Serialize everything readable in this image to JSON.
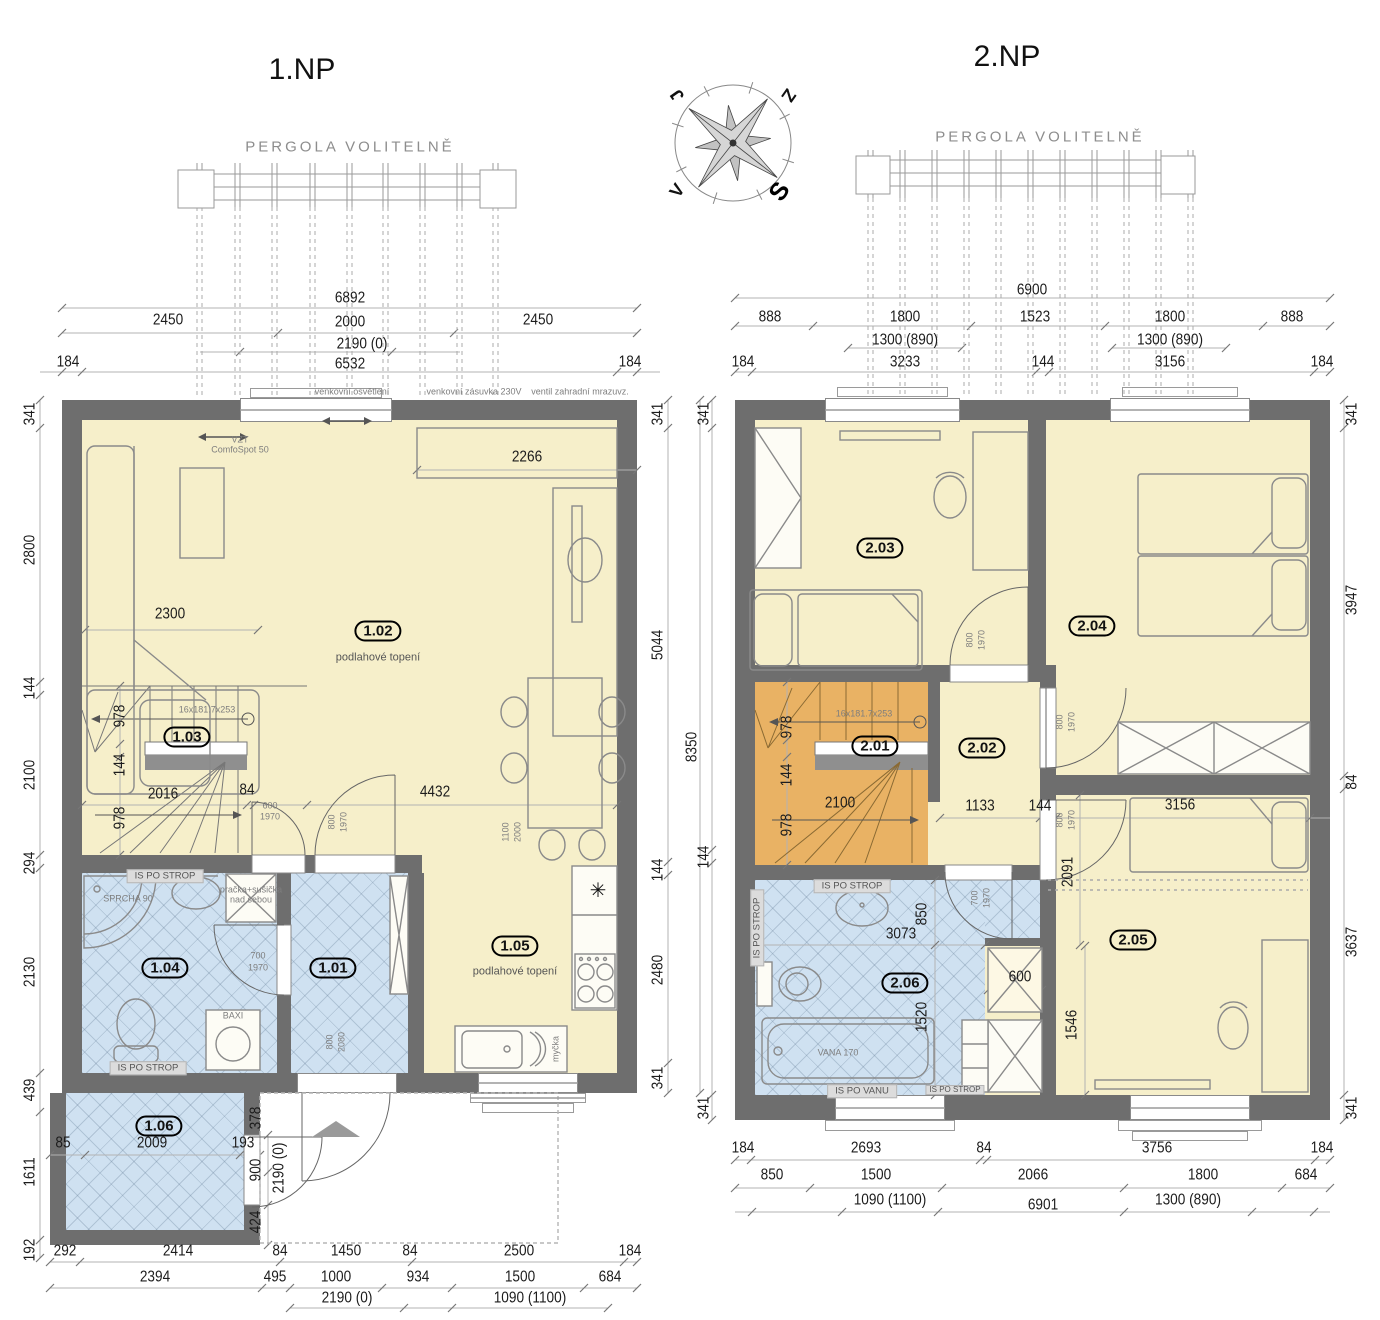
{
  "colors": {
    "wall": "#6e6e6e",
    "dry_room": "#f6efca",
    "wet_room": "#cfe1f1",
    "stairs_upper": "#e9b264",
    "band": "#dcdcdc"
  },
  "compass": {
    "ne": "Z",
    "nw": "J",
    "sw": "V",
    "se": "S"
  },
  "plan1": {
    "title": "1.NP",
    "pergola_label": "PERGOLA VOLITELNĚ",
    "labels": [
      {
        "t": "6892",
        "x": 350,
        "y": 298,
        "s": "dim"
      },
      {
        "t": "2450",
        "x": 168,
        "y": 320,
        "s": "dim"
      },
      {
        "t": "2000",
        "x": 350,
        "y": 322,
        "s": "dim"
      },
      {
        "t": "2450",
        "x": 538,
        "y": 320,
        "s": "dim"
      },
      {
        "t": "2190 (0)",
        "x": 362,
        "y": 344,
        "s": "dim"
      },
      {
        "t": "184",
        "x": 68,
        "y": 362,
        "s": "dim"
      },
      {
        "t": "6532",
        "x": 350,
        "y": 364,
        "s": "dim"
      },
      {
        "t": "184",
        "x": 630,
        "y": 362,
        "s": "dim"
      },
      {
        "t": "venkovní osvětlení",
        "x": 352,
        "y": 392,
        "s": "tiny"
      },
      {
        "t": "venkovní zásuvka 230V",
        "x": 474,
        "y": 392,
        "s": "tiny"
      },
      {
        "t": "ventil zahradní mrazuvz.",
        "x": 580,
        "y": 392,
        "s": "tiny"
      },
      {
        "t": "VZT",
        "x": 240,
        "y": 440,
        "s": "tiny"
      },
      {
        "t": "ComfoSpot 50",
        "x": 240,
        "y": 450,
        "s": "tiny"
      },
      {
        "t": "341",
        "x": 30,
        "y": 414,
        "s": "dimr"
      },
      {
        "t": "2800",
        "x": 30,
        "y": 550,
        "s": "dimr"
      },
      {
        "t": "144",
        "x": 30,
        "y": 688,
        "s": "dimr"
      },
      {
        "t": "2100",
        "x": 30,
        "y": 775,
        "s": "dimr"
      },
      {
        "t": "294",
        "x": 30,
        "y": 863,
        "s": "dimr"
      },
      {
        "t": "2130",
        "x": 30,
        "y": 972,
        "s": "dimr"
      },
      {
        "t": "439",
        "x": 30,
        "y": 1090,
        "s": "dimr"
      },
      {
        "t": "1611",
        "x": 30,
        "y": 1172,
        "s": "dimr"
      },
      {
        "t": "192",
        "x": 30,
        "y": 1250,
        "s": "dimr"
      },
      {
        "t": "341",
        "x": 658,
        "y": 414,
        "s": "dimr"
      },
      {
        "t": "5044",
        "x": 658,
        "y": 645,
        "s": "dimr"
      },
      {
        "t": "144",
        "x": 658,
        "y": 870,
        "s": "dimr"
      },
      {
        "t": "2480",
        "x": 658,
        "y": 970,
        "s": "dimr"
      },
      {
        "t": "341",
        "x": 658,
        "y": 1078,
        "s": "dimr"
      },
      {
        "t": "8350",
        "x": 692,
        "y": 747,
        "s": "dimr"
      },
      {
        "t": "292",
        "x": 65,
        "y": 1251,
        "s": "dim"
      },
      {
        "t": "2414",
        "x": 178,
        "y": 1251,
        "s": "dim"
      },
      {
        "t": "84",
        "x": 280,
        "y": 1251,
        "s": "dim"
      },
      {
        "t": "1450",
        "x": 346,
        "y": 1251,
        "s": "dim"
      },
      {
        "t": "84",
        "x": 410,
        "y": 1251,
        "s": "dim"
      },
      {
        "t": "2500",
        "x": 519,
        "y": 1251,
        "s": "dim"
      },
      {
        "t": "184",
        "x": 630,
        "y": 1251,
        "s": "dim"
      },
      {
        "t": "2394",
        "x": 155,
        "y": 1277,
        "s": "dim"
      },
      {
        "t": "495",
        "x": 275,
        "y": 1277,
        "s": "dim"
      },
      {
        "t": "1000",
        "x": 336,
        "y": 1277,
        "s": "dim"
      },
      {
        "t": "934",
        "x": 418,
        "y": 1277,
        "s": "dim"
      },
      {
        "t": "1500",
        "x": 520,
        "y": 1277,
        "s": "dim"
      },
      {
        "t": "684",
        "x": 610,
        "y": 1277,
        "s": "dim"
      },
      {
        "t": "2190 (0)",
        "x": 347,
        "y": 1298,
        "s": "dim"
      },
      {
        "t": "1090 (1100)",
        "x": 530,
        "y": 1298,
        "s": "dim"
      },
      {
        "t": "1.02",
        "x": 378,
        "y": 631,
        "s": "oval"
      },
      {
        "t": "podlahové topení",
        "x": 378,
        "y": 658,
        "s": "note"
      },
      {
        "t": "2266",
        "x": 527,
        "y": 457,
        "s": "dim"
      },
      {
        "t": "2300",
        "x": 170,
        "y": 614,
        "s": "dim"
      },
      {
        "t": "4432",
        "x": 435,
        "y": 792,
        "s": "dim"
      },
      {
        "t": "1.03",
        "x": 187,
        "y": 737,
        "s": "oval"
      },
      {
        "t": "16x181.7x253",
        "x": 207,
        "y": 710,
        "s": "tiny"
      },
      {
        "t": "978",
        "x": 120,
        "y": 716,
        "s": "dimr"
      },
      {
        "t": "144",
        "x": 120,
        "y": 765,
        "s": "dimr"
      },
      {
        "t": "978",
        "x": 120,
        "y": 818,
        "s": "dimr"
      },
      {
        "t": "2016",
        "x": 163,
        "y": 794,
        "s": "dim"
      },
      {
        "t": "84",
        "x": 247,
        "y": 790,
        "s": "dim"
      },
      {
        "t": "600",
        "x": 270,
        "y": 806,
        "s": "tiny"
      },
      {
        "t": "1970",
        "x": 270,
        "y": 817,
        "s": "tiny"
      },
      {
        "t": "800",
        "x": 332,
        "y": 822,
        "s": "tinyr"
      },
      {
        "t": "1970",
        "x": 344,
        "y": 822,
        "s": "tinyr"
      },
      {
        "t": "1100",
        "x": 506,
        "y": 832,
        "s": "tinyr"
      },
      {
        "t": "2000",
        "x": 518,
        "y": 832,
        "s": "tinyr"
      },
      {
        "t": "IS PO STROP",
        "x": 165,
        "y": 876,
        "s": "band"
      },
      {
        "t": "IS PO STROP",
        "x": 148,
        "y": 1068,
        "s": "band"
      },
      {
        "t": "SPRCHA 90",
        "x": 128,
        "y": 899,
        "s": "tiny"
      },
      {
        "t": "pračka+sušička",
        "x": 251,
        "y": 890,
        "s": "tiny"
      },
      {
        "t": "nad sebou",
        "x": 251,
        "y": 900,
        "s": "tiny"
      },
      {
        "t": "1.04",
        "x": 165,
        "y": 968,
        "s": "oval"
      },
      {
        "t": "700",
        "x": 258,
        "y": 956,
        "s": "tiny"
      },
      {
        "t": "1970",
        "x": 258,
        "y": 968,
        "s": "tiny"
      },
      {
        "t": "1.01",
        "x": 333,
        "y": 968,
        "s": "oval"
      },
      {
        "t": "800",
        "x": 330,
        "y": 1042,
        "s": "tinyr"
      },
      {
        "t": "2080",
        "x": 342,
        "y": 1042,
        "s": "tinyr"
      },
      {
        "t": "BAXI",
        "x": 233,
        "y": 1016,
        "s": "tiny"
      },
      {
        "t": "1.05",
        "x": 515,
        "y": 946,
        "s": "oval"
      },
      {
        "t": "podlahové topení",
        "x": 515,
        "y": 972,
        "s": "note"
      },
      {
        "t": "✳",
        "x": 598,
        "y": 891,
        "s": "sym",
        "n": "fridge-freezer-icon"
      },
      {
        "t": "myčka",
        "x": 556,
        "y": 1049,
        "s": "tinyr"
      },
      {
        "t": "1.06",
        "x": 159,
        "y": 1126,
        "s": "oval"
      },
      {
        "t": "2009",
        "x": 152,
        "y": 1143,
        "s": "dim"
      },
      {
        "t": "85",
        "x": 63,
        "y": 1143,
        "s": "dim"
      },
      {
        "t": "193",
        "x": 243,
        "y": 1143,
        "s": "dim"
      },
      {
        "t": "378",
        "x": 256,
        "y": 1118,
        "s": "dimr"
      },
      {
        "t": "900",
        "x": 256,
        "y": 1170,
        "s": "dimr"
      },
      {
        "t": "2190 (0)",
        "x": 279,
        "y": 1168,
        "s": "dimr"
      },
      {
        "t": "424",
        "x": 256,
        "y": 1222,
        "s": "dimr"
      }
    ]
  },
  "plan2": {
    "title": "2.NP",
    "pergola_label": "PERGOLA VOLITELNĚ",
    "labels": [
      {
        "t": "6900",
        "x": 1032,
        "y": 290,
        "s": "dim"
      },
      {
        "t": "888",
        "x": 770,
        "y": 317,
        "s": "dim"
      },
      {
        "t": "1800",
        "x": 905,
        "y": 317,
        "s": "dim"
      },
      {
        "t": "1523",
        "x": 1035,
        "y": 317,
        "s": "dim"
      },
      {
        "t": "1800",
        "x": 1170,
        "y": 317,
        "s": "dim"
      },
      {
        "t": "888",
        "x": 1292,
        "y": 317,
        "s": "dim"
      },
      {
        "t": "1300 (890)",
        "x": 905,
        "y": 340,
        "s": "dim"
      },
      {
        "t": "1300 (890)",
        "x": 1170,
        "y": 340,
        "s": "dim"
      },
      {
        "t": "184",
        "x": 743,
        "y": 362,
        "s": "dim"
      },
      {
        "t": "3233",
        "x": 905,
        "y": 362,
        "s": "dim"
      },
      {
        "t": "144",
        "x": 1043,
        "y": 362,
        "s": "dim"
      },
      {
        "t": "3156",
        "x": 1170,
        "y": 362,
        "s": "dim"
      },
      {
        "t": "184",
        "x": 1322,
        "y": 362,
        "s": "dim"
      },
      {
        "t": "341",
        "x": 704,
        "y": 414,
        "s": "dimr"
      },
      {
        "t": "144",
        "x": 704,
        "y": 857,
        "s": "dimr"
      },
      {
        "t": "341",
        "x": 704,
        "y": 1108,
        "s": "dimr"
      },
      {
        "t": "341",
        "x": 1352,
        "y": 414,
        "s": "dimr"
      },
      {
        "t": "3947",
        "x": 1352,
        "y": 600,
        "s": "dimr"
      },
      {
        "t": "84",
        "x": 1352,
        "y": 782,
        "s": "dimr"
      },
      {
        "t": "3637",
        "x": 1352,
        "y": 942,
        "s": "dimr"
      },
      {
        "t": "341",
        "x": 1352,
        "y": 1108,
        "s": "dimr"
      },
      {
        "t": "184",
        "x": 743,
        "y": 1148,
        "s": "dim"
      },
      {
        "t": "2693",
        "x": 866,
        "y": 1148,
        "s": "dim"
      },
      {
        "t": "84",
        "x": 984,
        "y": 1148,
        "s": "dim"
      },
      {
        "t": "3756",
        "x": 1157,
        "y": 1148,
        "s": "dim"
      },
      {
        "t": "184",
        "x": 1322,
        "y": 1148,
        "s": "dim"
      },
      {
        "t": "850",
        "x": 772,
        "y": 1175,
        "s": "dim"
      },
      {
        "t": "1500",
        "x": 876,
        "y": 1175,
        "s": "dim"
      },
      {
        "t": "2066",
        "x": 1033,
        "y": 1175,
        "s": "dim"
      },
      {
        "t": "1800",
        "x": 1203,
        "y": 1175,
        "s": "dim"
      },
      {
        "t": "684",
        "x": 1306,
        "y": 1175,
        "s": "dim"
      },
      {
        "t": "1090 (1100)",
        "x": 890,
        "y": 1200,
        "s": "dim"
      },
      {
        "t": "6901",
        "x": 1043,
        "y": 1205,
        "s": "dim"
      },
      {
        "t": "1300 (890)",
        "x": 1188,
        "y": 1200,
        "s": "dim"
      },
      {
        "t": "2.03",
        "x": 880,
        "y": 548,
        "s": "oval"
      },
      {
        "t": "800",
        "x": 970,
        "y": 640,
        "s": "tinyr"
      },
      {
        "t": "1970",
        "x": 982,
        "y": 640,
        "s": "tinyr"
      },
      {
        "t": "2.04",
        "x": 1092,
        "y": 626,
        "s": "oval"
      },
      {
        "t": "16x181.7x253",
        "x": 864,
        "y": 714,
        "s": "tiny"
      },
      {
        "t": "2.01",
        "x": 875,
        "y": 746,
        "s": "oval"
      },
      {
        "t": "978",
        "x": 787,
        "y": 727,
        "s": "dimr"
      },
      {
        "t": "144",
        "x": 787,
        "y": 775,
        "s": "dimr"
      },
      {
        "t": "978",
        "x": 787,
        "y": 825,
        "s": "dimr"
      },
      {
        "t": "2100",
        "x": 840,
        "y": 803,
        "s": "dim"
      },
      {
        "t": "2.02",
        "x": 982,
        "y": 748,
        "s": "oval"
      },
      {
        "t": "1133",
        "x": 980,
        "y": 806,
        "s": "dim"
      },
      {
        "t": "144",
        "x": 1040,
        "y": 806,
        "s": "dim"
      },
      {
        "t": "800",
        "x": 1060,
        "y": 722,
        "s": "tinyr"
      },
      {
        "t": "1970",
        "x": 1072,
        "y": 722,
        "s": "tinyr"
      },
      {
        "t": "800",
        "x": 1060,
        "y": 820,
        "s": "tinyr"
      },
      {
        "t": "1970",
        "x": 1072,
        "y": 820,
        "s": "tinyr"
      },
      {
        "t": "IS PO STROP",
        "x": 852,
        "y": 886,
        "s": "band"
      },
      {
        "t": "IS PO STROP",
        "x": 757,
        "y": 928,
        "s": "bandr"
      },
      {
        "t": "3073",
        "x": 901,
        "y": 934,
        "s": "dim"
      },
      {
        "t": "850",
        "x": 922,
        "y": 914,
        "s": "dimr"
      },
      {
        "t": "2.06",
        "x": 905,
        "y": 983,
        "s": "oval"
      },
      {
        "t": "1520",
        "x": 922,
        "y": 1017,
        "s": "dimr"
      },
      {
        "t": "VANA 170",
        "x": 838,
        "y": 1053,
        "s": "tiny"
      },
      {
        "t": "IS PO VANU",
        "x": 862,
        "y": 1091,
        "s": "band"
      },
      {
        "t": "IS PO STROP",
        "x": 955,
        "y": 1090,
        "s": "bandsm"
      },
      {
        "t": "700",
        "x": 975,
        "y": 898,
        "s": "tinyr"
      },
      {
        "t": "1970",
        "x": 987,
        "y": 898,
        "s": "tinyr"
      },
      {
        "t": "600",
        "x": 1020,
        "y": 977,
        "s": "dim"
      },
      {
        "t": "3156",
        "x": 1180,
        "y": 805,
        "s": "dim"
      },
      {
        "t": "2091",
        "x": 1068,
        "y": 872,
        "s": "dimr"
      },
      {
        "t": "2.05",
        "x": 1133,
        "y": 940,
        "s": "oval"
      },
      {
        "t": "1546",
        "x": 1072,
        "y": 1025,
        "s": "dimr"
      }
    ]
  }
}
